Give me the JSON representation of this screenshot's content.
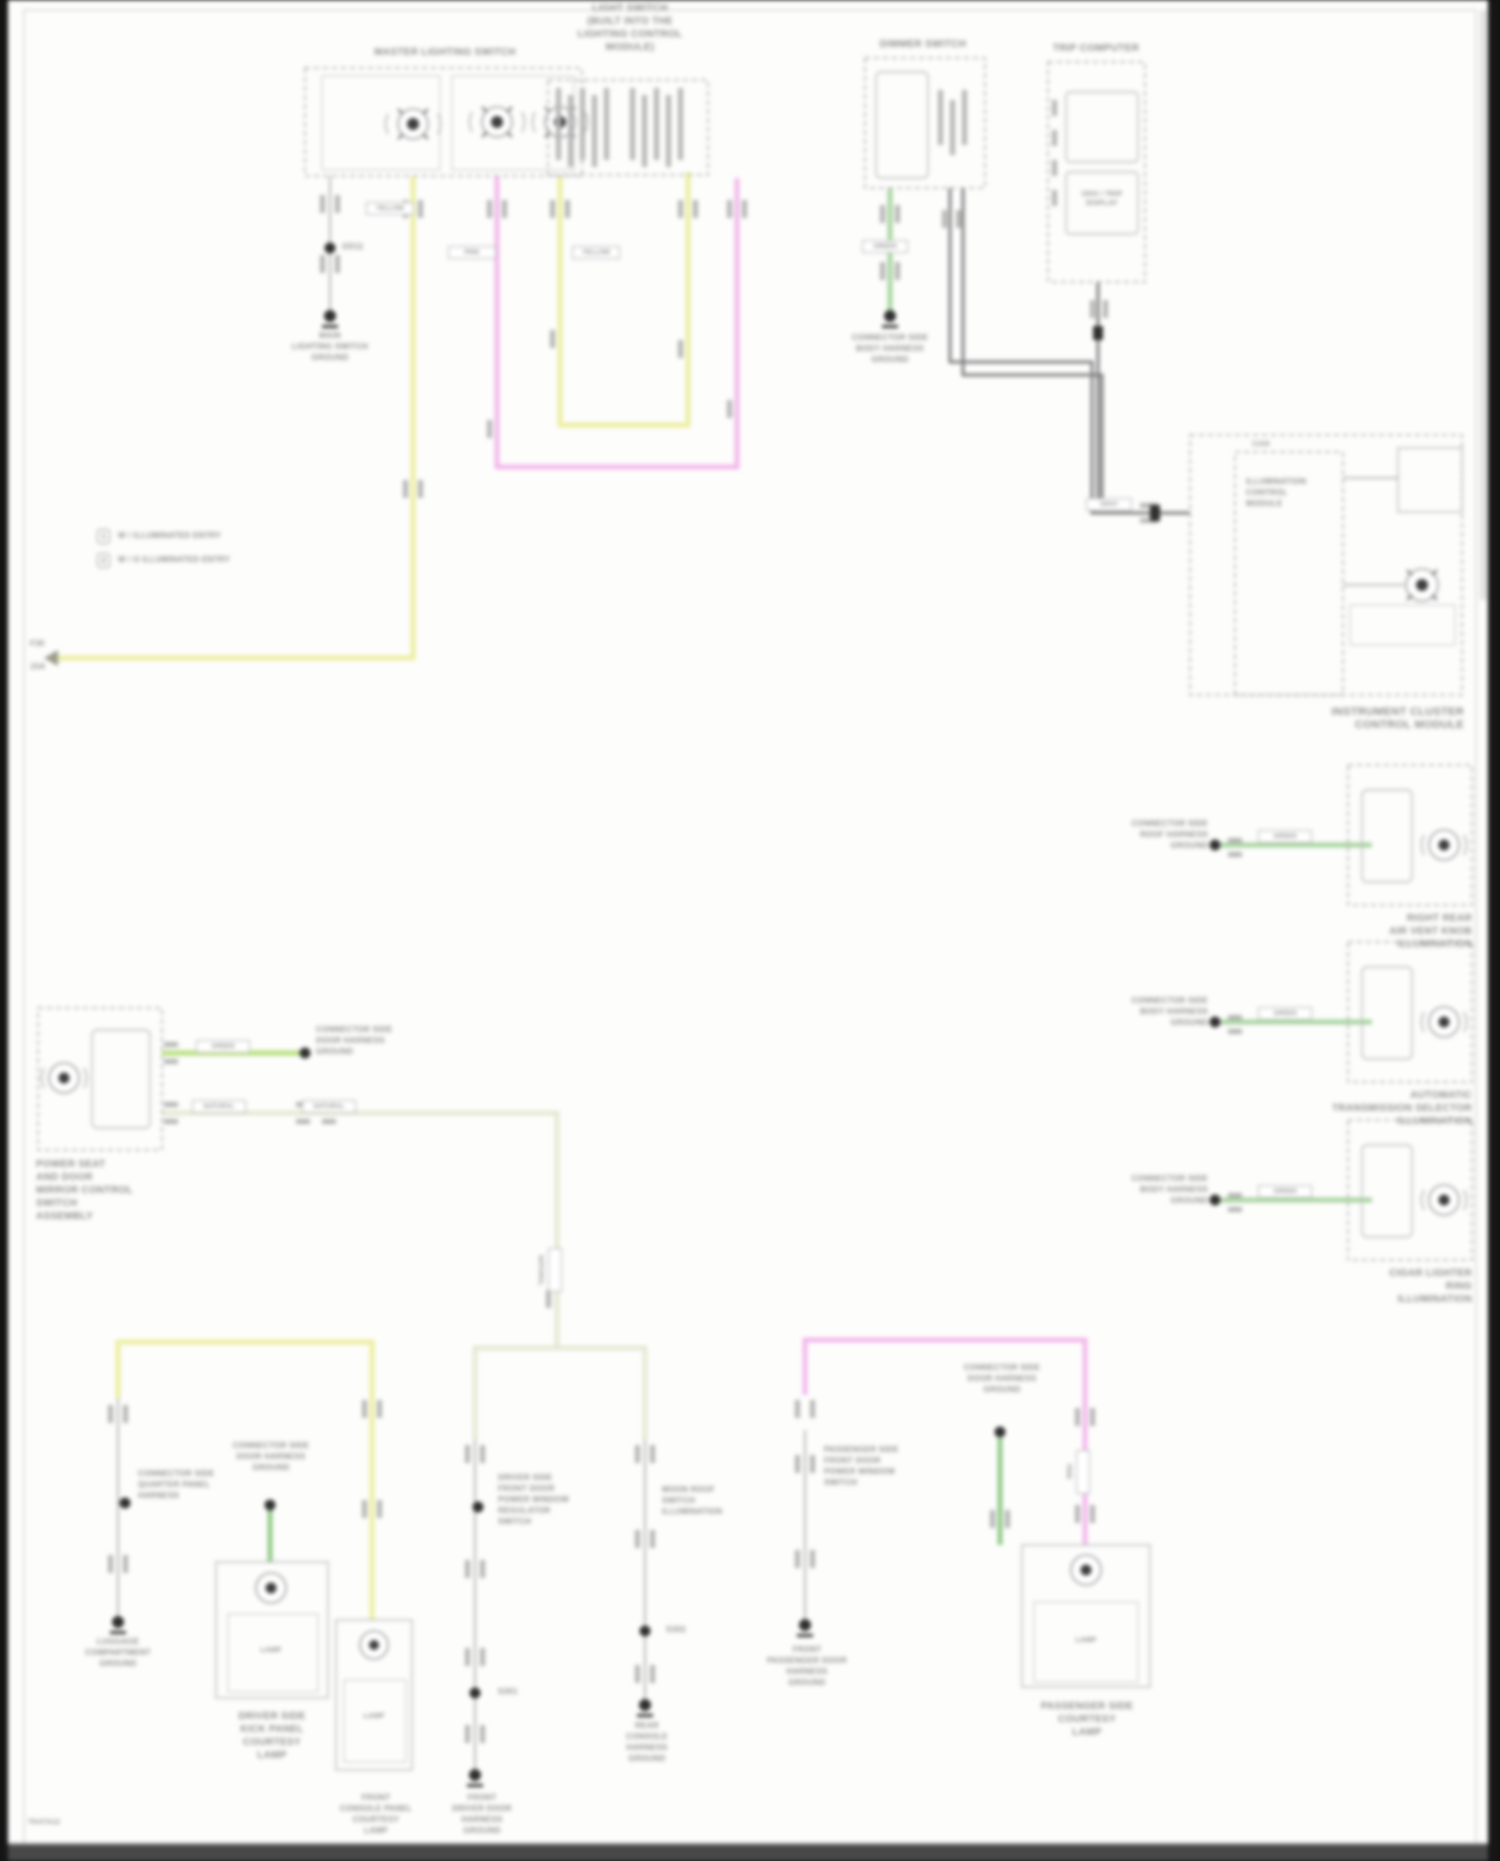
{
  "legend": {
    "item1_num": "1",
    "item1_text": "W / ILLUMINATED ENTRY",
    "item2_num": "2",
    "item2_text": "W / O ILLUMINATED ENTRY"
  },
  "master_switch": {
    "title": "MASTER LIGHTING SWITCH",
    "ground_splice": "GD11",
    "ground_label": "MAIN\nLIGHTING SWITCH\nGROUND",
    "fuse_row1": "F30",
    "fuse_row2": "15A"
  },
  "light_check": {
    "title": "LIGHT SWITCH\n(BUILT INTO THE\nLIGHTING CONTROL\nMODULE)"
  },
  "dimmer": {
    "title": "DIMMER SWITCH",
    "ground_label": "CONNECTOR SIDE\nBODY HARNESS\nGROUND"
  },
  "trip_computer": {
    "title": "TRIP COMPUTER",
    "display_label": "ODO / TRIP\nDISPLAY"
  },
  "cluster": {
    "connector_id": "C230",
    "inner_label": "ILLUMINATION\nCONTROL\nMODULE",
    "name": "INSTRUMENT CLUSTER\nCONTROL MODULE",
    "wire_label": "GRAY"
  },
  "right_units": {
    "u1": {
      "connector_label": "CONNECTOR SIDE\nROOF HARNESS\nGROUND",
      "wire_label": "GREEN",
      "name": "RIGHT REAR\nAIR VENT KNOB\nILLUMINATION"
    },
    "u2": {
      "connector_label": "CONNECTOR SIDE\nBODY HARNESS\nGROUND",
      "wire_label": "GREEN",
      "name": "AUTOMATIC\nTRANSMISSION SELECTOR\nILLUMINATION"
    },
    "u3": {
      "connector_label": "CONNECTOR SIDE\nBODY HARNESS\nGROUND",
      "wire_label": "GREEN",
      "name": "CIGAR LIGHTER\nRING\nILLUMINATION"
    }
  },
  "mirror_switch": {
    "name": "POWER SEAT\nAND DOOR\nMIRROR CONTROL\nSWITCH\nASSEMBLY",
    "connector_label": "CONNECTOR SIDE\nDOOR HARNESS\nGROUND",
    "wire_label_green": "GREEN",
    "wire_label_nat1": "NATURAL",
    "wire_label_nat2": "NATURAL",
    "wire_label_vert": "NATURAL"
  },
  "bl_col": {
    "connector_label": "CONNECTOR SIDE\nQUARTER PANEL\nHARNESS",
    "ground_label": "LUGGAGE\nCOMPARTMENT\nGROUND"
  },
  "door_lamp": {
    "connector_label": "CONNECTOR SIDE\nDOOR HARNESS\nGROUND",
    "inner": "LAMP",
    "name": "DRIVER SIDE\nKICK PANEL\nCOURTESY\nLAMP"
  },
  "console_lamp": {
    "inner": "LAMP",
    "name": "FRONT\nCONSOLE PANEL\nCOURTESY\nLAMP"
  },
  "colA": {
    "side_label": "DRIVER SIDE\nFRONT DOOR\nPOWER WINDOW\nREGULATOR\nSWITCH",
    "splice": "S301",
    "ground_label": "FRONT\nDRIVER DOOR\nHARNESS\nGROUND"
  },
  "colB": {
    "side_label": "MOON ROOF\nSWITCH\nILLUMINATION",
    "splice": "S302",
    "ground_label": "REAR\nCONSOLE\nHARNESS\nGROUND"
  },
  "pink_col": {
    "side_label": "PASSENGER SIDE\nFRONT DOOR\nPOWER WINDOW\nSWITCH",
    "ground_label": "FRONT\nPASSENGER DOOR\nHARNESS\nGROUND",
    "wire_label": "PINK"
  },
  "courtesy_lamp_r": {
    "connector_label": "CONNECTOR SIDE\nDOOR HARNESS\nGROUND",
    "inner": "LAMP",
    "name": "PASSENGER SIDE\nCOURTESY\nLAMP"
  },
  "wire_tags": {
    "yellow1": "YELLOW",
    "pink1": "PINK",
    "yellow2": "YELLOW",
    "green_dimmer": "GREEN"
  },
  "footer": {
    "code": "TK47A12"
  }
}
